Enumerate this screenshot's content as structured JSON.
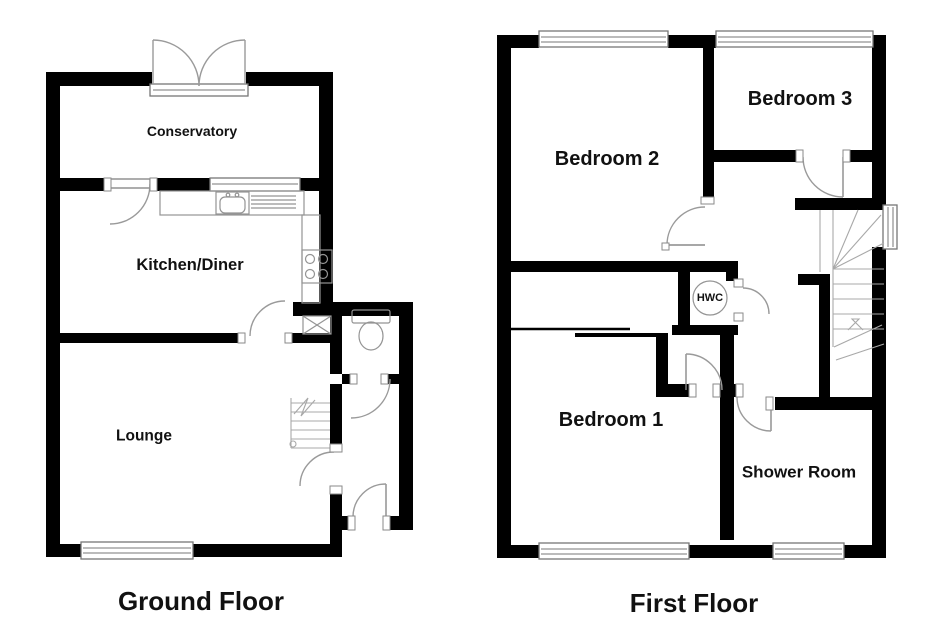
{
  "plan": {
    "background": "#ffffff",
    "wall_color": "#000000",
    "fixture_color": "#949494",
    "ground_floor": {
      "title": "Ground Floor",
      "room_labels": {
        "conservatory": "Conservatory",
        "kitchen_diner": "Kitchen/Diner",
        "lounge": "Lounge"
      }
    },
    "first_floor": {
      "title": "First Floor",
      "room_labels": {
        "bedroom2": "Bedroom 2",
        "bedroom3": "Bedroom 3",
        "bedroom1": "Bedroom 1",
        "shower_room": "Shower Room",
        "hwc": "HWC"
      }
    }
  }
}
